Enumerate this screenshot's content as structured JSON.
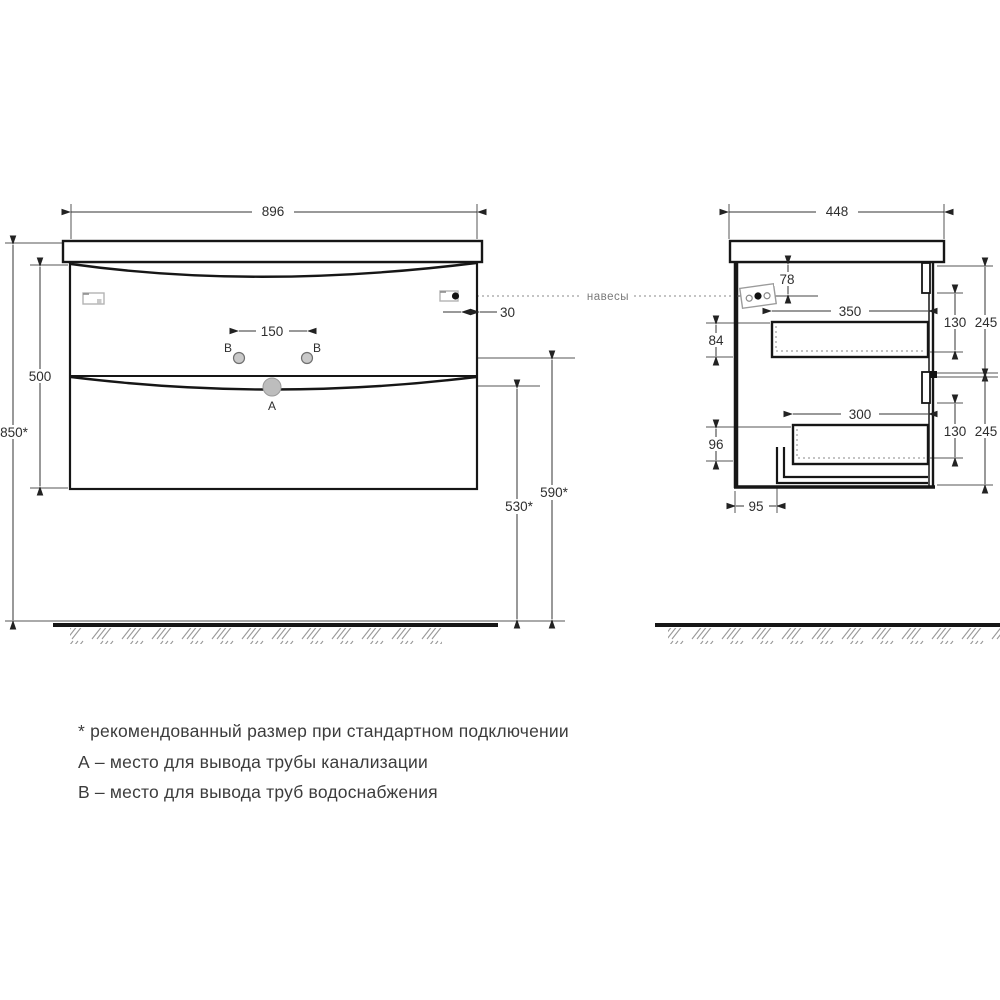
{
  "drawing": {
    "center_label": "навесы",
    "front": {
      "width": "896",
      "cabinet_height": "500",
      "total_height": "850*",
      "water_spacing": "150",
      "hanger_offset": "30",
      "water_height": "590*",
      "drain_height": "530*",
      "label_a": "A",
      "label_b_left": "B",
      "label_b_right": "B"
    },
    "side": {
      "width": "448",
      "hanger_top": "78",
      "top_drawer_width": "350",
      "top_left_gap": "84",
      "top_drawer_height": "130",
      "top_zone_height": "245",
      "bottom_drawer_width": "300",
      "bottom_left_gap": "96",
      "bottom_drawer_height": "130",
      "bottom_zone_height": "245",
      "recess_offset": "95"
    }
  },
  "legend": {
    "line1": "* рекомендованный размер при стандартном подключении",
    "line2": "А – место для вывода трубы канализации",
    "line3": "В – место для вывода труб водоснабжения"
  }
}
